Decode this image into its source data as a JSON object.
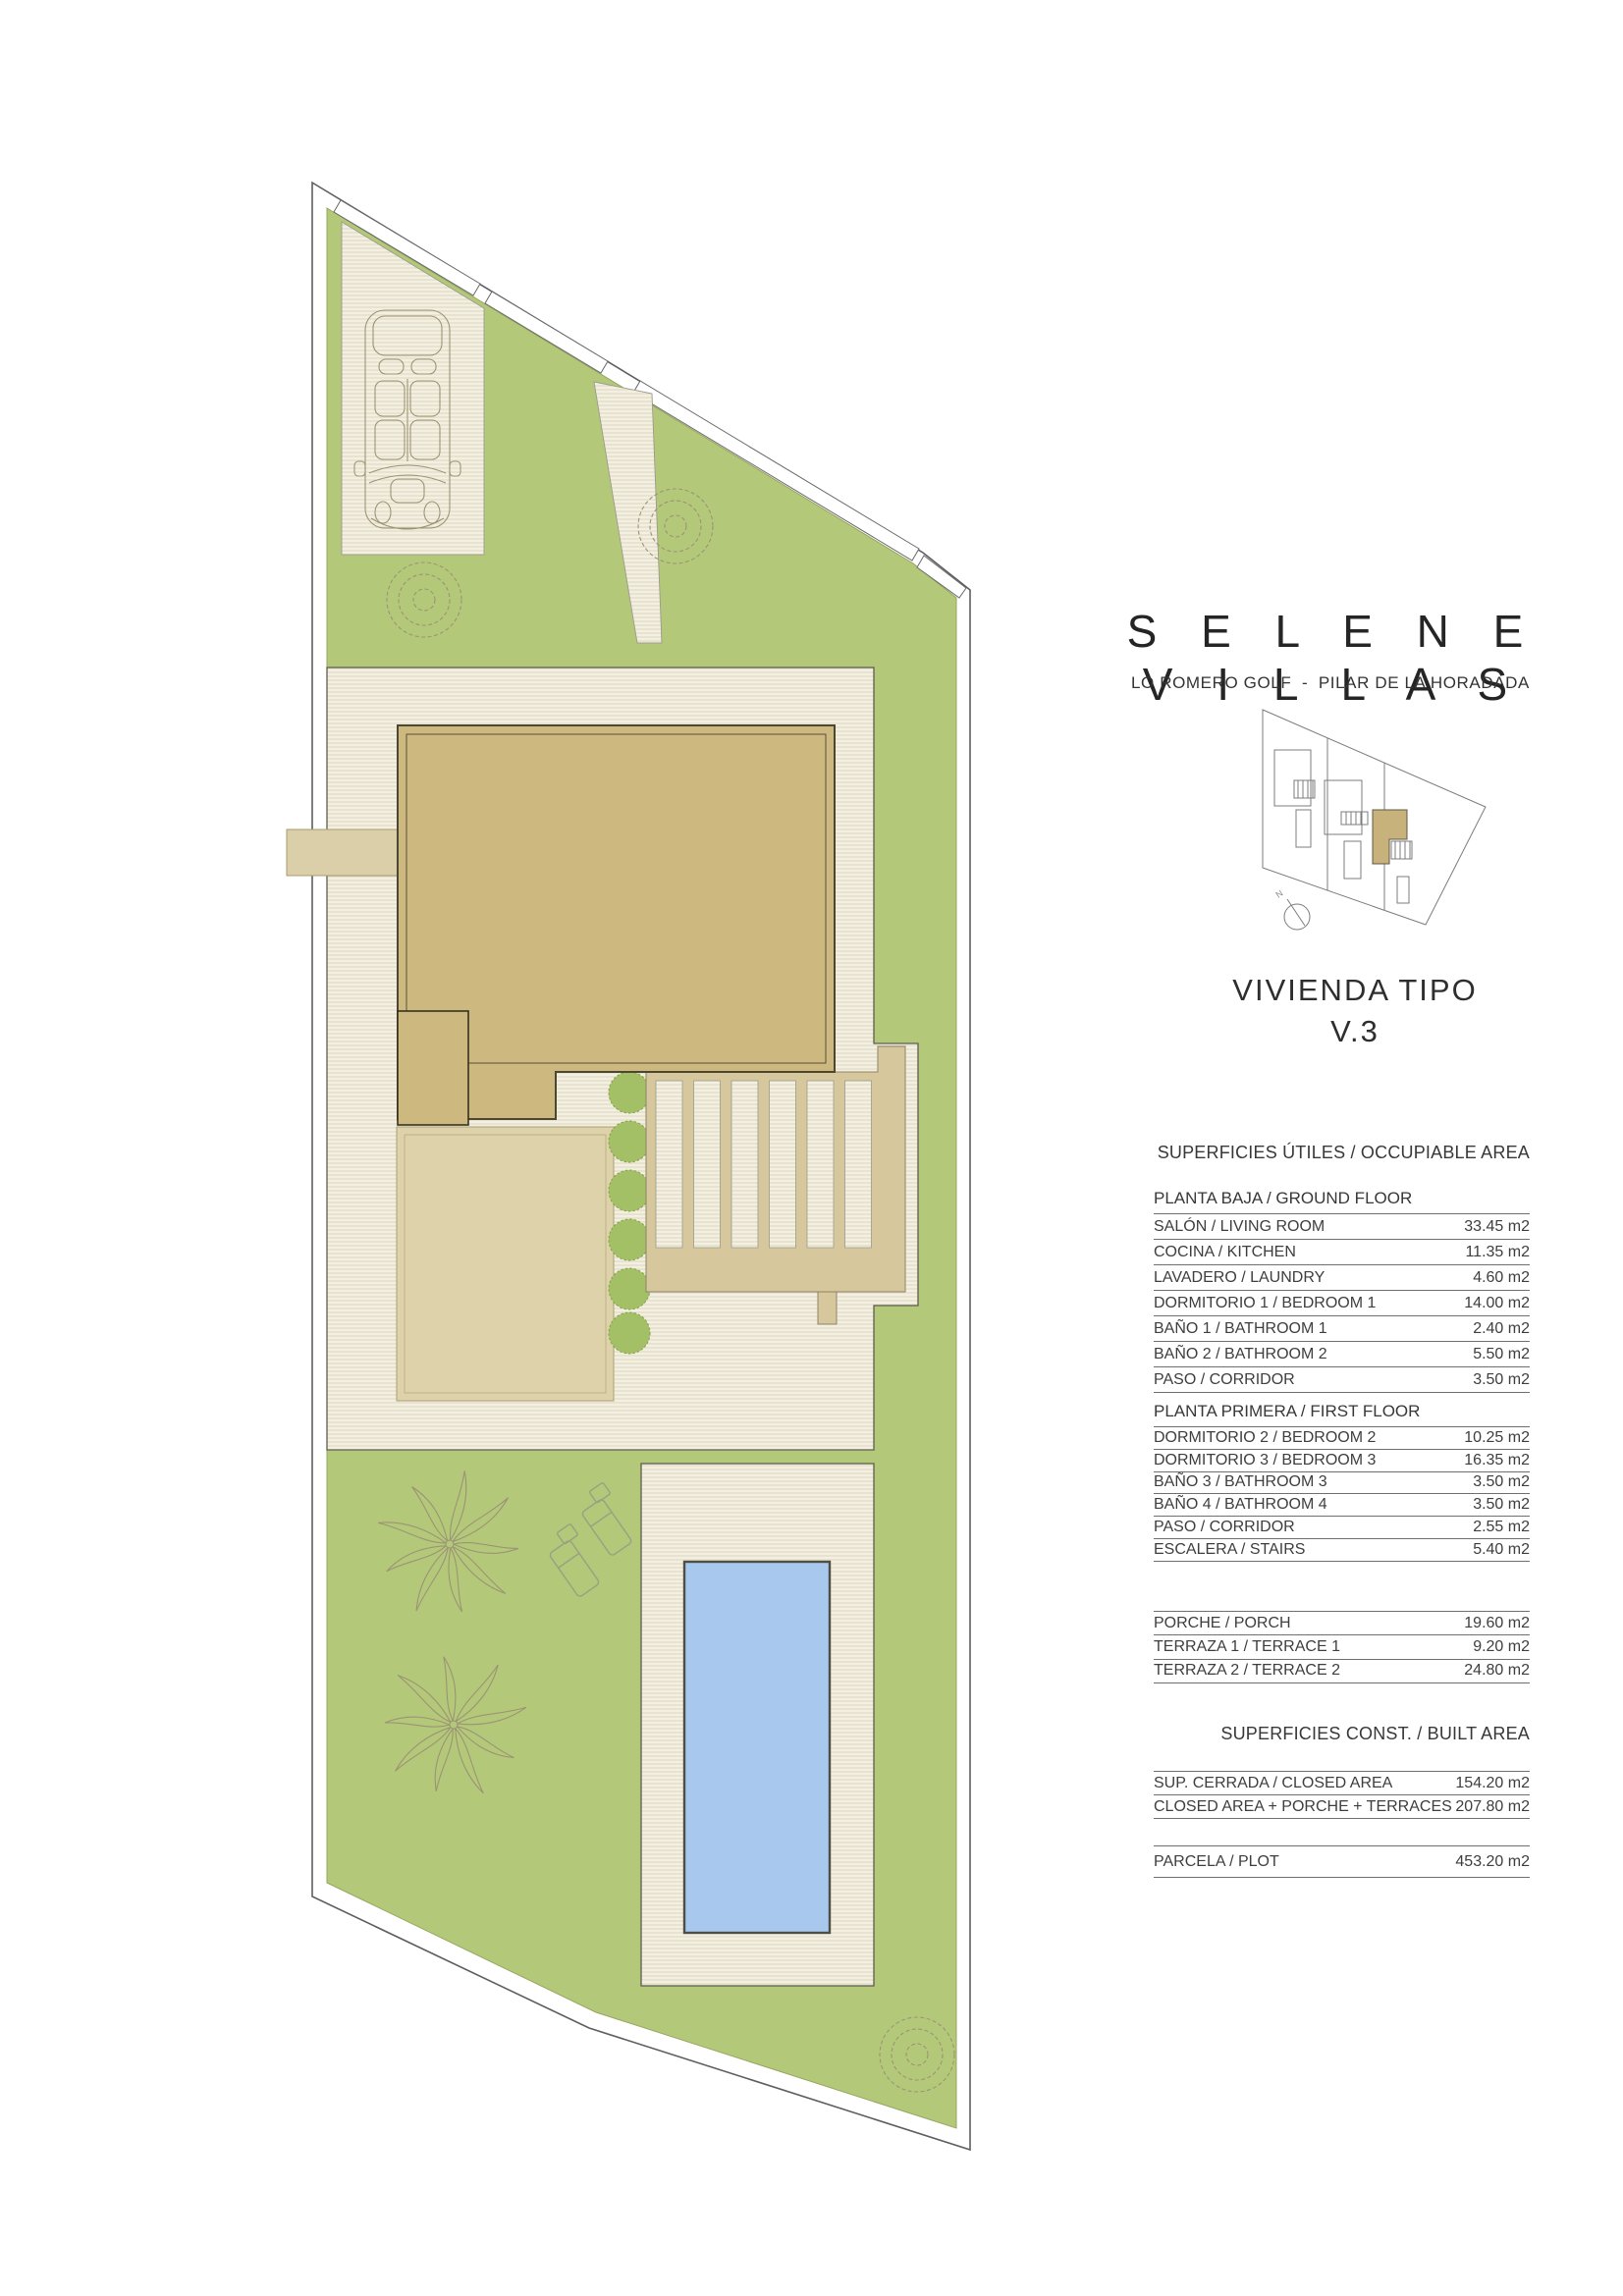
{
  "header": {
    "title": "S E L E N E   V I L L A S",
    "subtitle": "LO ROMERO GOLF  -  PILAR DE LA HORADADA"
  },
  "unit": {
    "label": "VIVIENDA TIPO",
    "code": "V.3"
  },
  "sections": {
    "occupiable_heading": "SUPERFICIES ÚTILES / OCCUPIABLE AREA",
    "built_heading": "SUPERFICIES  CONST. / BUILT AREA"
  },
  "tables": {
    "ground": {
      "heading": "PLANTA BAJA / GROUND FLOOR",
      "rows": [
        {
          "label": "SALÓN / LIVING ROOM",
          "value": "33.45 m2"
        },
        {
          "label": "COCINA / KITCHEN",
          "value": "11.35 m2"
        },
        {
          "label": "LAVADERO / LAUNDRY",
          "value": "4.60 m2"
        },
        {
          "label": "DORMITORIO 1 /  BEDROOM 1",
          "value": "14.00 m2"
        },
        {
          "label": "BAÑO 1 / BATHROOM 1",
          "value": "2.40 m2"
        },
        {
          "label": "BAÑO 2 / BATHROOM 2",
          "value": "5.50 m2"
        },
        {
          "label": "PASO / CORRIDOR",
          "value": "3.50 m2"
        }
      ]
    },
    "first": {
      "heading": "PLANTA PRIMERA / FIRST FLOOR",
      "rows": [
        {
          "label": "DORMITORIO 2 / BEDROOM 2",
          "value": "10.25 m2"
        },
        {
          "label": "DORMITORIO 3 / BEDROOM 3",
          "value": "16.35 m2"
        },
        {
          "label": "BAÑO 3 / BATHROOM 3",
          "value": "3.50 m2"
        },
        {
          "label": "BAÑO 4 / BATHROOM 4",
          "value": "3.50 m2"
        },
        {
          "label": "PASO / CORRIDOR",
          "value": "2.55 m2"
        },
        {
          "label": "ESCALERA / STAIRS",
          "value": "5.40 m2"
        }
      ]
    },
    "outdoor": {
      "rows": [
        {
          "label": "PORCHE / PORCH",
          "value": "19.60 m2"
        },
        {
          "label": "TERRAZA 1 / TERRACE 1",
          "value": "9.20 m2"
        },
        {
          "label": "TERRAZA 2 / TERRACE 2",
          "value": "24.80 m2"
        }
      ]
    },
    "built": {
      "rows": [
        {
          "label": "SUP. CERRADA / CLOSED AREA",
          "value": "154.20 m2"
        },
        {
          "label": "CLOSED AREA + PORCHE + TERRACES",
          "value": "207.80 m2"
        }
      ]
    },
    "plot": {
      "rows": [
        {
          "label": "PARCELA / PLOT",
          "value": "453.20 m2"
        }
      ]
    }
  },
  "plan": {
    "north_label": "N"
  },
  "colors": {
    "grass": "#b4c87a",
    "paving": "#f4f0e1",
    "hatchline": "#ddd6bf",
    "housetan": "#cdb87f",
    "terracebeige": "#ded2ab",
    "pergolatan": "#d6c79c",
    "hedgegreen": "#a4c066",
    "poolblue": "#a9c8ed",
    "lineart": "#9b9474",
    "maptan": "#c8b27c"
  }
}
